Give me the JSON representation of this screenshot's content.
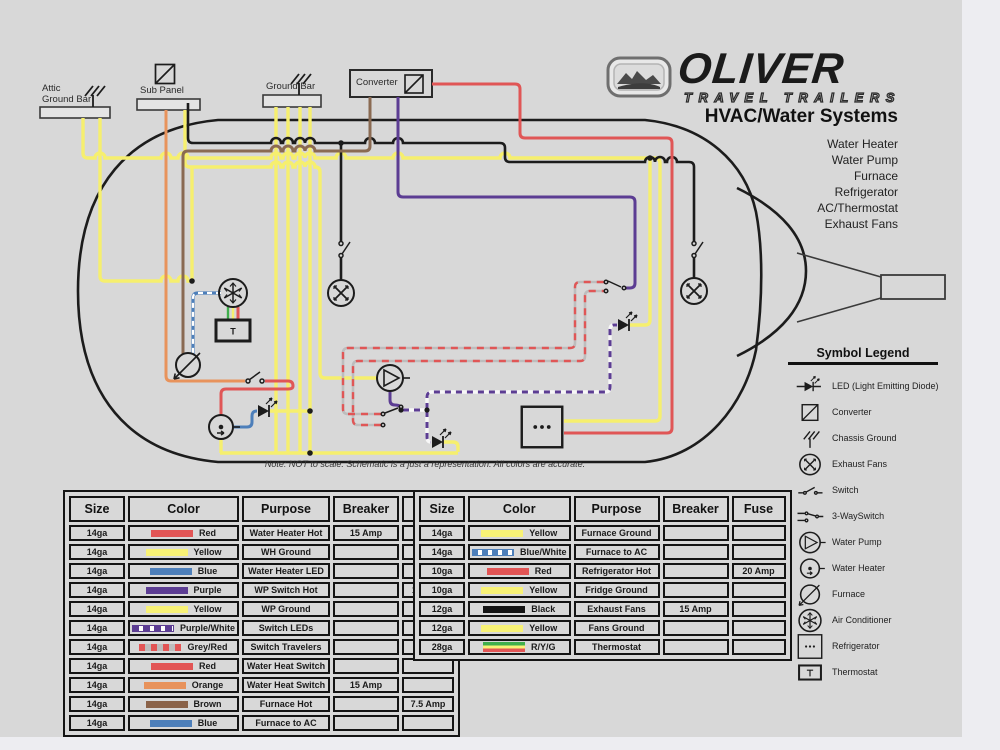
{
  "page": {
    "bg": "#d8d8d8",
    "margin_bg": "#ededf1"
  },
  "logo": {
    "brand": "OLIVER",
    "tagline": "TRAVEL TRAILERS"
  },
  "header": {
    "title": "HVAC/Water Systems",
    "systems": [
      "Water Heater",
      "Water Pump",
      "Furnace",
      "Refrigerator",
      "AC/Thermostat",
      "Exhaust Fans"
    ]
  },
  "diagram": {
    "labels": {
      "attic_line1": "Attic",
      "attic_line2": "Ground Bar",
      "sub_panel": "Sub Panel",
      "ground_bar": "Ground Bar",
      "converter": "Converter",
      "thermostat": "T"
    },
    "note": "Note:  NOT to scale.  Schematic is a just a representation.  All colors are accurate."
  },
  "wire_colors": {
    "red": "#e05656",
    "yellow": "#f6ef6e",
    "blue": "#4d7fba",
    "purple": "#5c3d93",
    "orange": "#e8935c",
    "brown": "#8a6a52",
    "black": "#1c1c1c",
    "grey": "#bdbdbd",
    "green": "#3fae4c"
  },
  "legend": {
    "title": "Symbol Legend",
    "items": [
      {
        "icon": "led",
        "label": "LED (Light Emitting Diode)"
      },
      {
        "icon": "converter",
        "label": "Converter"
      },
      {
        "icon": "ground",
        "label": "Chassis Ground"
      },
      {
        "icon": "fan",
        "label": "Exhaust Fans"
      },
      {
        "icon": "switch",
        "label": "Switch"
      },
      {
        "icon": "threeway",
        "label": "3-WaySwitch"
      },
      {
        "icon": "pump",
        "label": "Water Pump"
      },
      {
        "icon": "waterheater",
        "label": "Water Heater"
      },
      {
        "icon": "furnace",
        "label": "Furnace"
      },
      {
        "icon": "ac",
        "label": "Air Conditioner"
      },
      {
        "icon": "fridge",
        "label": "Refrigerator"
      },
      {
        "icon": "thermostat",
        "label": "Thermostat"
      }
    ]
  },
  "tables": [
    {
      "headers": [
        "Size",
        "Color",
        "Purpose",
        "Breaker",
        "Fuse"
      ],
      "rows": [
        {
          "size": "14ga",
          "color": "Red",
          "swatch": "red",
          "purpose": "Water Heater Hot",
          "breaker": "15 Amp",
          "fuse": ""
        },
        {
          "size": "14ga",
          "color": "Yellow",
          "swatch": "yellow",
          "purpose": "WH Ground",
          "breaker": "",
          "fuse": ""
        },
        {
          "size": "14ga",
          "color": "Blue",
          "swatch": "blue",
          "purpose": "Water Heater LED",
          "breaker": "",
          "fuse": ""
        },
        {
          "size": "14ga",
          "color": "Purple",
          "swatch": "purple",
          "purpose": "WP Switch Hot",
          "breaker": "",
          "fuse": "15 Amp"
        },
        {
          "size": "14ga",
          "color": "Yellow",
          "swatch": "yellow",
          "purpose": "WP Ground",
          "breaker": "",
          "fuse": ""
        },
        {
          "size": "14ga",
          "color": "Purple/White",
          "swatch": "purple-white",
          "purpose": "Switch LEDs",
          "breaker": "",
          "fuse": ""
        },
        {
          "size": "14ga",
          "color": "Grey/Red",
          "swatch": "grey-red",
          "purpose": "Switch Travelers",
          "breaker": "",
          "fuse": ""
        },
        {
          "size": "14ga",
          "color": "Red",
          "swatch": "red",
          "purpose": "Water Heat Switch",
          "breaker": "",
          "fuse": ""
        },
        {
          "size": "14ga",
          "color": "Orange",
          "swatch": "orange",
          "purpose": "Water Heat Switch",
          "breaker": "15 Amp",
          "fuse": ""
        },
        {
          "size": "14ga",
          "color": "Brown",
          "swatch": "brown",
          "purpose": "Furnace Hot",
          "breaker": "",
          "fuse": "7.5 Amp"
        },
        {
          "size": "14ga",
          "color": "Blue",
          "swatch": "blue",
          "purpose": "Furnace to AC",
          "breaker": "",
          "fuse": ""
        }
      ]
    },
    {
      "headers": [
        "Size",
        "Color",
        "Purpose",
        "Breaker",
        "Fuse"
      ],
      "rows": [
        {
          "size": "14ga",
          "color": "Yellow",
          "swatch": "yellow",
          "purpose": "Furnace Ground",
          "breaker": "",
          "fuse": ""
        },
        {
          "size": "14ga",
          "color": "Blue/White",
          "swatch": "blue-white",
          "purpose": "Furnace to AC",
          "breaker": "",
          "fuse": ""
        },
        {
          "size": "10ga",
          "color": "Red",
          "swatch": "red",
          "purpose": "Refrigerator Hot",
          "breaker": "",
          "fuse": "20 Amp"
        },
        {
          "size": "10ga",
          "color": "Yellow",
          "swatch": "yellow",
          "purpose": "Fridge Ground",
          "breaker": "",
          "fuse": ""
        },
        {
          "size": "12ga",
          "color": "Black",
          "swatch": "black",
          "purpose": "Exhaust Fans",
          "breaker": "15 Amp",
          "fuse": ""
        },
        {
          "size": "12ga",
          "color": "Yellow",
          "swatch": "yellow",
          "purpose": "Fans Ground",
          "breaker": "",
          "fuse": ""
        },
        {
          "size": "28ga",
          "color": "R/Y/G",
          "swatch": "ryg",
          "purpose": "Thermostat",
          "breaker": "",
          "fuse": ""
        }
      ]
    }
  ]
}
